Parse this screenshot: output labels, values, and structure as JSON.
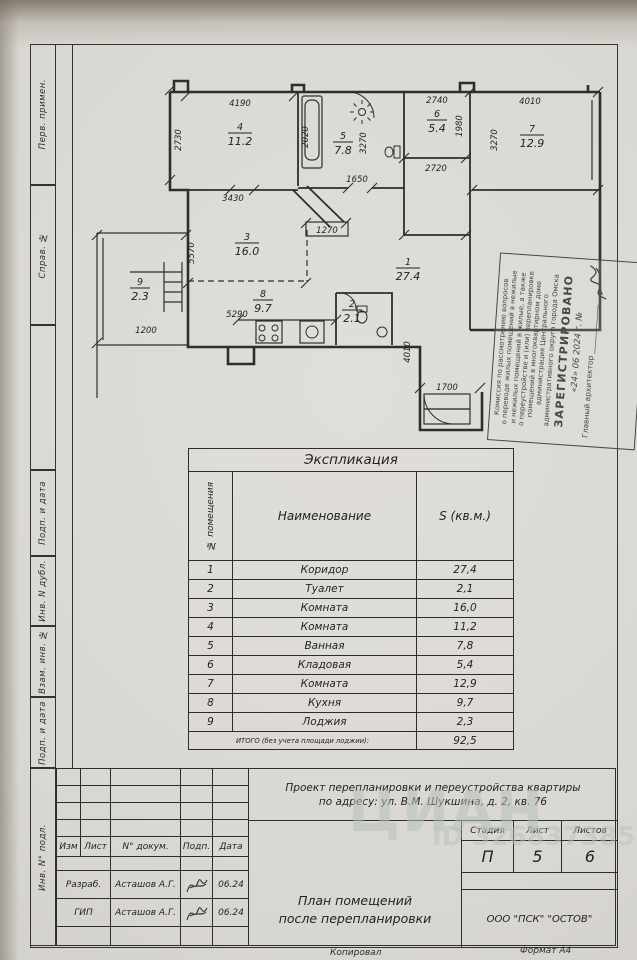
{
  "margin_labels": [
    "Перв. примен.",
    "Справ. №",
    "Подп. и дата",
    "Инв. N дубл.",
    "Взам. инв. №",
    "Подп. и дата",
    "Инв. N° подл."
  ],
  "plan": {
    "rooms": [
      {
        "num": "1",
        "area": "27.4"
      },
      {
        "num": "2",
        "area": "2.1"
      },
      {
        "num": "3",
        "area": "16.0"
      },
      {
        "num": "4",
        "area": "11.2"
      },
      {
        "num": "5",
        "area": "7.8"
      },
      {
        "num": "6",
        "area": "5.4"
      },
      {
        "num": "7",
        "area": "12.9"
      },
      {
        "num": "8",
        "area": "9.7"
      },
      {
        "num": "9",
        "area": "2.3"
      }
    ],
    "dims": [
      "4190",
      "2020",
      "2730",
      "3430",
      "1650",
      "2740",
      "1980",
      "2720",
      "3270",
      "4010",
      "3270",
      "1270",
      "5570",
      "1200",
      "5290",
      "4010",
      "1700"
    ]
  },
  "stamp": {
    "lines": [
      "Комиссия по рассмотрению вопросов",
      "о переводе жилых помещений в нежилые",
      "и нежилых помещений в жилые, а также",
      "о переустройстве и (или) перепланировке",
      "помещений в многоквартирном доме",
      "администрация Центрального",
      "административного округа города Омска"
    ],
    "registered": "ЗАРЕГИСТРИРОВАНО",
    "date_line": "«24» 06 2024 г. №",
    "signer": "Главный архитектор _____________"
  },
  "table": {
    "title": "Экспликация",
    "col_num": "№ помещения",
    "col_name": "Наименование",
    "col_area": "S (кв.м.)",
    "rows": [
      {
        "n": "1",
        "name": "Коридор",
        "s": "27,4"
      },
      {
        "n": "2",
        "name": "Туалет",
        "s": "2,1"
      },
      {
        "n": "3",
        "name": "Комната",
        "s": "16,0"
      },
      {
        "n": "4",
        "name": "Комната",
        "s": "11,2"
      },
      {
        "n": "5",
        "name": "Ванная",
        "s": "7,8"
      },
      {
        "n": "6",
        "name": "Кладовая",
        "s": "5,4"
      },
      {
        "n": "7",
        "name": "Комната",
        "s": "12,9"
      },
      {
        "n": "8",
        "name": "Кухня",
        "s": "9,7"
      },
      {
        "n": "9",
        "name": "Лоджия",
        "s": "2,3"
      }
    ],
    "total_label": "ИТОГО (без учета площади лоджии):",
    "total": "92,5"
  },
  "titleblock": {
    "project_line1": "Проект перепланировки и переустройства квартиры",
    "project_line2": "по адресу: ул. В.М. Шукшина, д. 2, кв. 76",
    "col_izm": "Изм",
    "col_list": "Лист",
    "col_dokum": "N° докум.",
    "col_podp": "Подп.",
    "col_data": "Дата",
    "stadia_label": "Стадия",
    "list_label": "Лист",
    "listov_label": "Листов",
    "stadia": "П",
    "list": "5",
    "listov": "6",
    "row1_role": "Разраб.",
    "row1_name": "Асташов А.Г.",
    "row1_date": "06.24",
    "row2_role": "ГИП",
    "row2_name": "Асташов А.Г.",
    "row2_date": "06.24",
    "drawing_title_line1": "План помещений",
    "drawing_title_line2": "после перепланировки",
    "org": "ООО \"ПСК\" \"ОСТОВ\"",
    "kopiroval": "Копировал",
    "format": "Формат А4"
  },
  "watermark": {
    "brand": "ЦИАН",
    "id_text": "ID 326837385"
  }
}
